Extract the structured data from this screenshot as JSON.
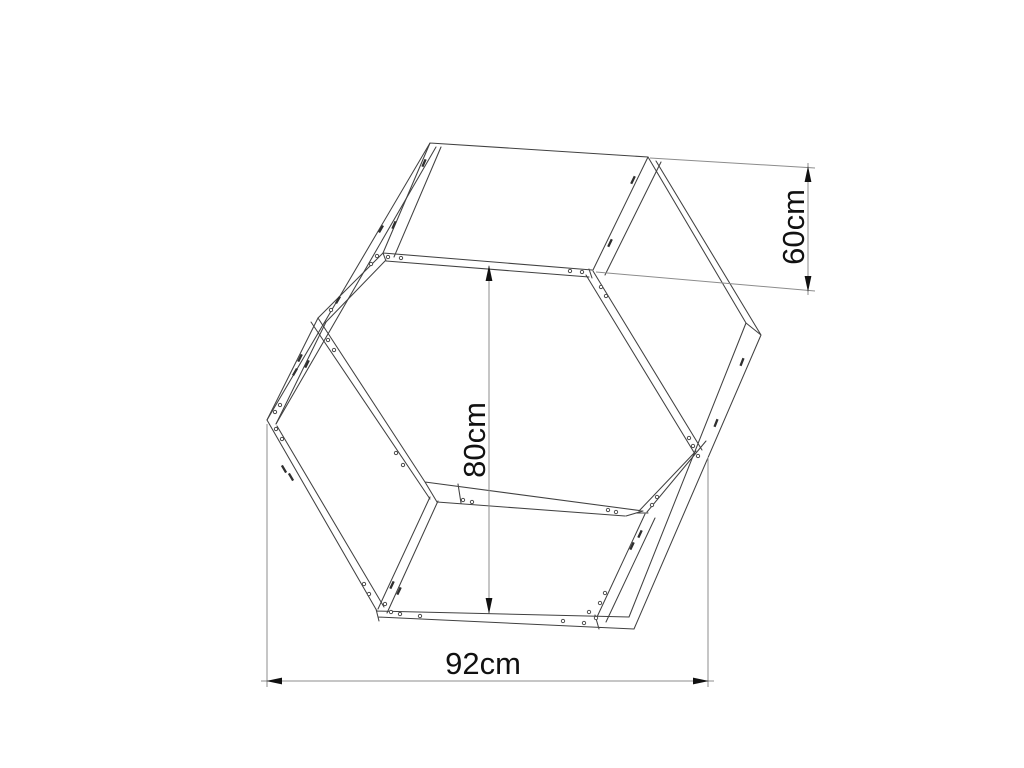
{
  "page": {
    "background": "#ffffff",
    "description": "Technical line drawing of a hexagonal wooden frame with dimension annotations"
  },
  "drawing": {
    "dimensions": {
      "height": "60cm",
      "across_flats": "80cm",
      "across_corners": "92cm"
    },
    "colors": {
      "frame_line": "#414141",
      "dimension_line": "#8c8c8c",
      "label_text": "#111111",
      "background": "#ffffff"
    }
  }
}
